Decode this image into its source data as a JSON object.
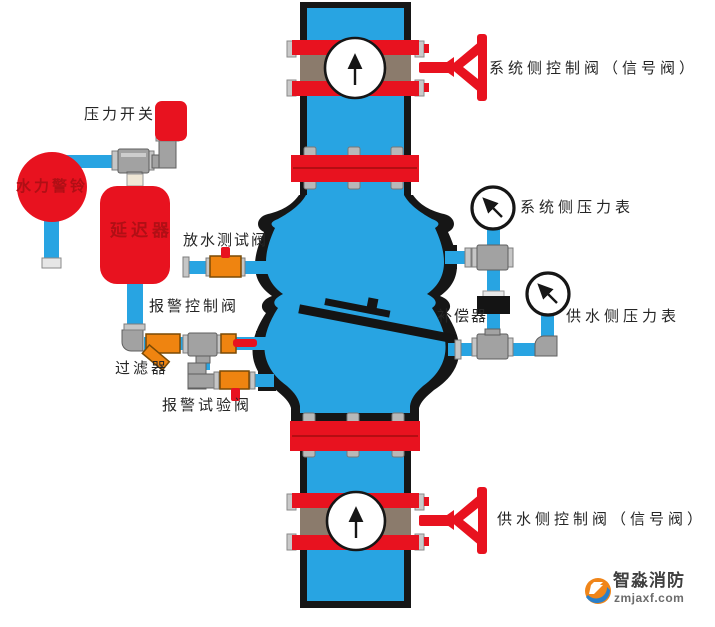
{
  "labels": {
    "pressure_switch": "压力开关",
    "water_motor_alarm": "水力警铃",
    "retard_chamber": "延迟器",
    "drain_test_valve": "放水测试阀",
    "alarm_control_valve": "报警控制阀",
    "filter": "过滤器",
    "alarm_test_valve": "报警试验阀",
    "system_side_control_valve": "系统侧控制阀（信号阀）",
    "system_side_pressure_gauge": "系统侧压力表",
    "compensator": "补偿器",
    "supply_side_pressure_gauge": "供水侧压力表",
    "supply_side_control_valve": "供水侧控制阀（信号阀）"
  },
  "logo": {
    "brand": "智淼消防",
    "domain": "zmjaxf.com"
  },
  "icons": {
    "flow_arrow": "↑",
    "gauge_needle": "↖"
  },
  "colors": {
    "pipe_blue": "#28a4e2",
    "component_red": "#e8121f",
    "valve_orange": "#ef8410",
    "fitting_gray": "#a2a2a2",
    "valve_body_brown": "#8b7b6c",
    "outline_black": "#161616",
    "label_dark_red": "#b00f15",
    "logo_blue": "#2a7fc9",
    "logo_orange": "#f08519"
  }
}
